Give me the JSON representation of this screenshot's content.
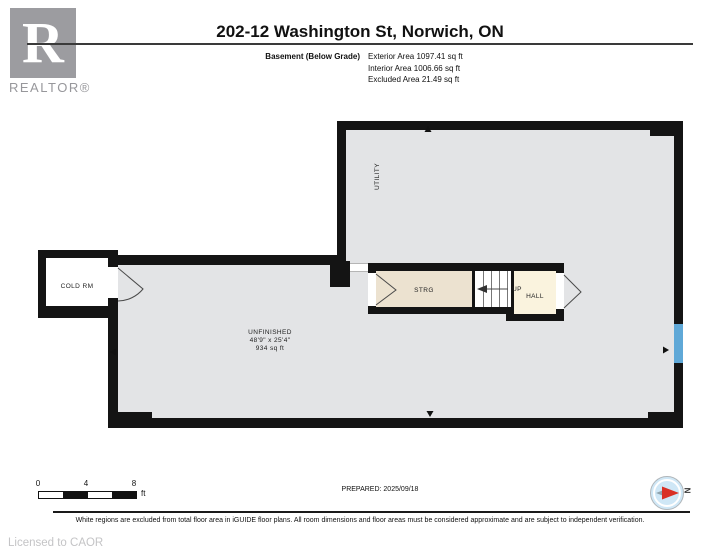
{
  "header": {
    "logo": {
      "letter": "R",
      "label": "REALTOR®"
    },
    "title": "202-12 Washington St, Norwich, ON",
    "floor_label": "Basement (Below Grade)",
    "area_lines": [
      "Exterior Area 1097.41 sq ft",
      "Interior Area 1006.66 sq ft",
      "Excluded Area 21.49 sq ft"
    ]
  },
  "plan": {
    "rooms": {
      "utility": "UTILITY",
      "cold_room": "COLD RM",
      "storage": "STRG",
      "stairs_up": "UP",
      "hall": "HALL",
      "unfinished": {
        "name": "UNFINISHED",
        "dimensions": "48'9\" x 25'4\"",
        "area": "934 sq ft"
      }
    }
  },
  "footer": {
    "scale_bar": {
      "ticks": [
        "0",
        "4",
        "8"
      ],
      "unit": "ft"
    },
    "prepared": "PREPARED: 2025/09/18",
    "compass_label": "N",
    "disclaimer": "White regions are excluded from total floor area in iGUIDE floor plans. All room dimensions and floor areas must be considered approximate and are subject to independent verification.",
    "license": "Licensed to CAOR"
  },
  "colors": {
    "wall": "#141414",
    "floor_gray": "#e3e4e6",
    "strg_fill": "#ece2d0",
    "hall_fill": "#faf3de",
    "window_blue": "#5fa8d7",
    "compass_blue": "#cfe7f6",
    "compass_red": "#d93025",
    "logo_gray": "#9c9ca0"
  }
}
